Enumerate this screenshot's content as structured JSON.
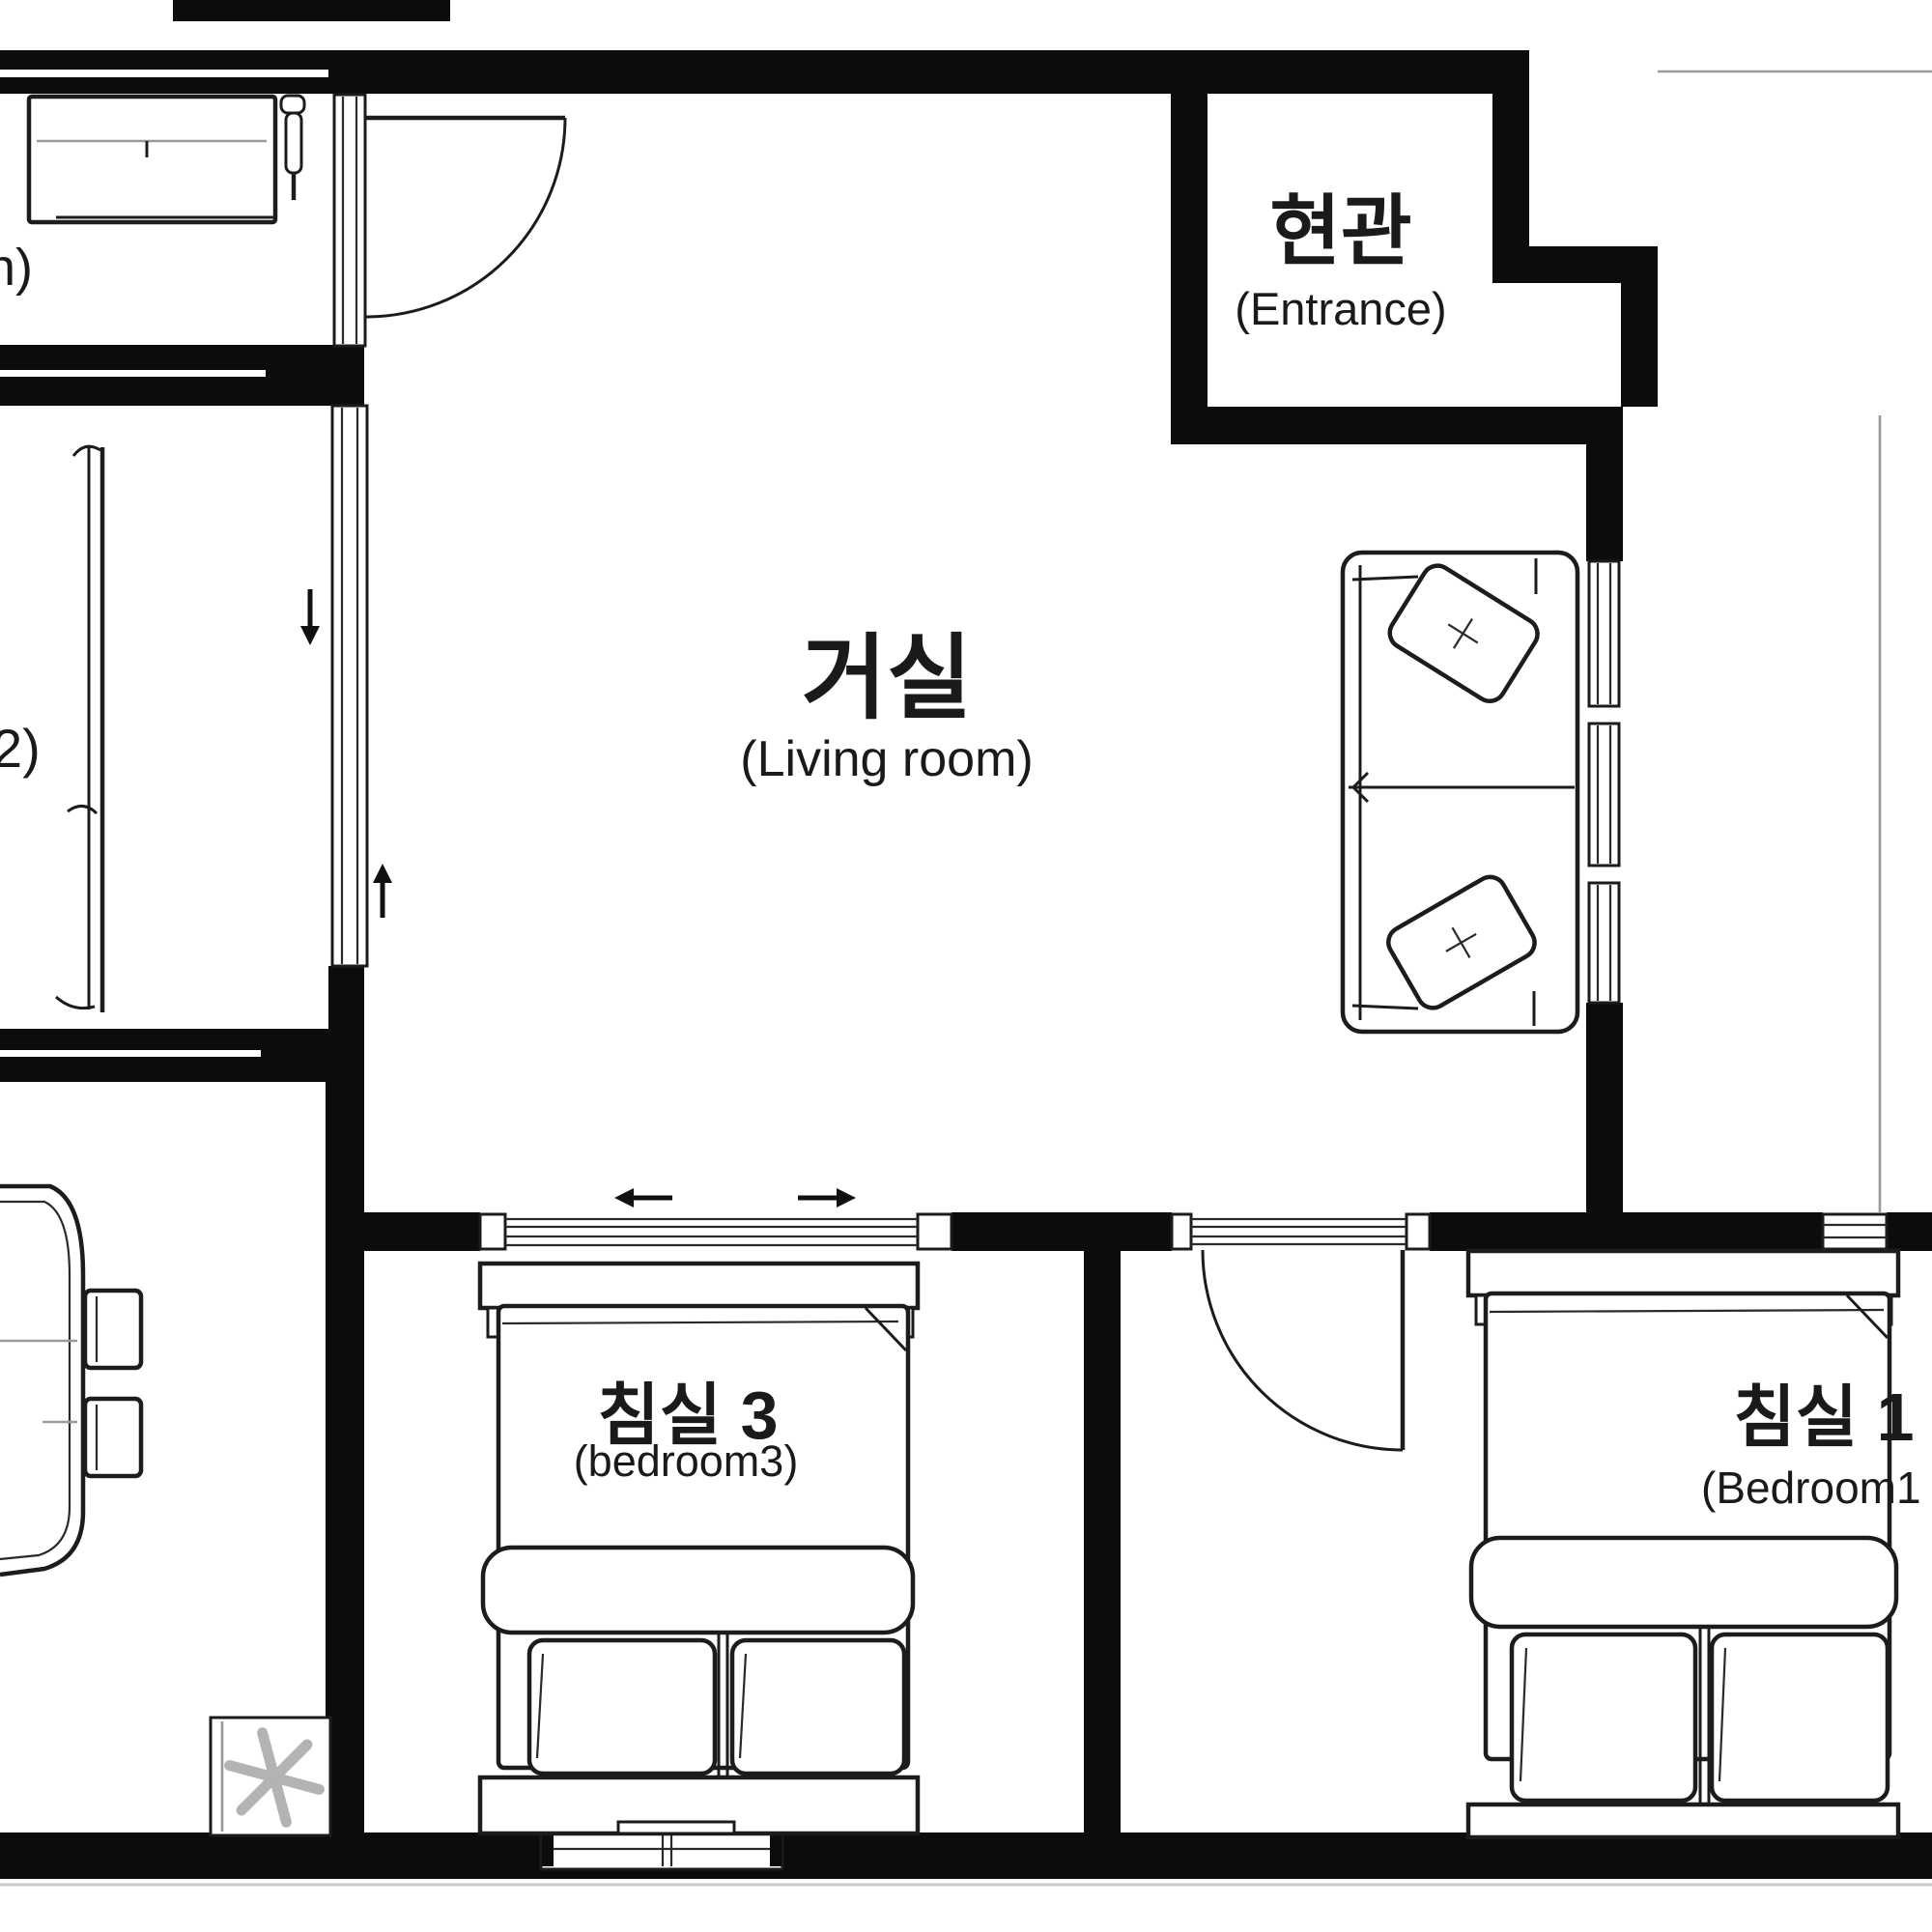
{
  "plan": {
    "title": "apartment-floor-plan",
    "rooms": {
      "living_room": {
        "label_kr": "거실",
        "label_en": "(Living room)"
      },
      "entrance": {
        "label_kr": "현관",
        "label_en": "(Entrance)"
      },
      "bedroom3": {
        "label_kr": "침실 3",
        "label_en": "(bedroom3)"
      },
      "bedroom1": {
        "label_kr": "침실 1",
        "label_en": "(Bedroom1"
      },
      "bathroom_cropped": {
        "label_fragment": "h)"
      },
      "bedroom2_cropped": {
        "label_fragment": "2)"
      },
      "dining_cropped": {
        "label_fragment": ")"
      }
    },
    "symbols": {
      "ac_fan_icon": "six-blade-fan",
      "door_swing_arcs": 2,
      "sliding_door_arrow_directions": [
        "down",
        "up",
        "left",
        "right"
      ]
    },
    "colors": {
      "wall": "#0c0c0c",
      "line": "#1c1c1c",
      "light_line": "#9a9a9a",
      "fan": "#b3b3b3",
      "background": "#ffffff"
    }
  }
}
